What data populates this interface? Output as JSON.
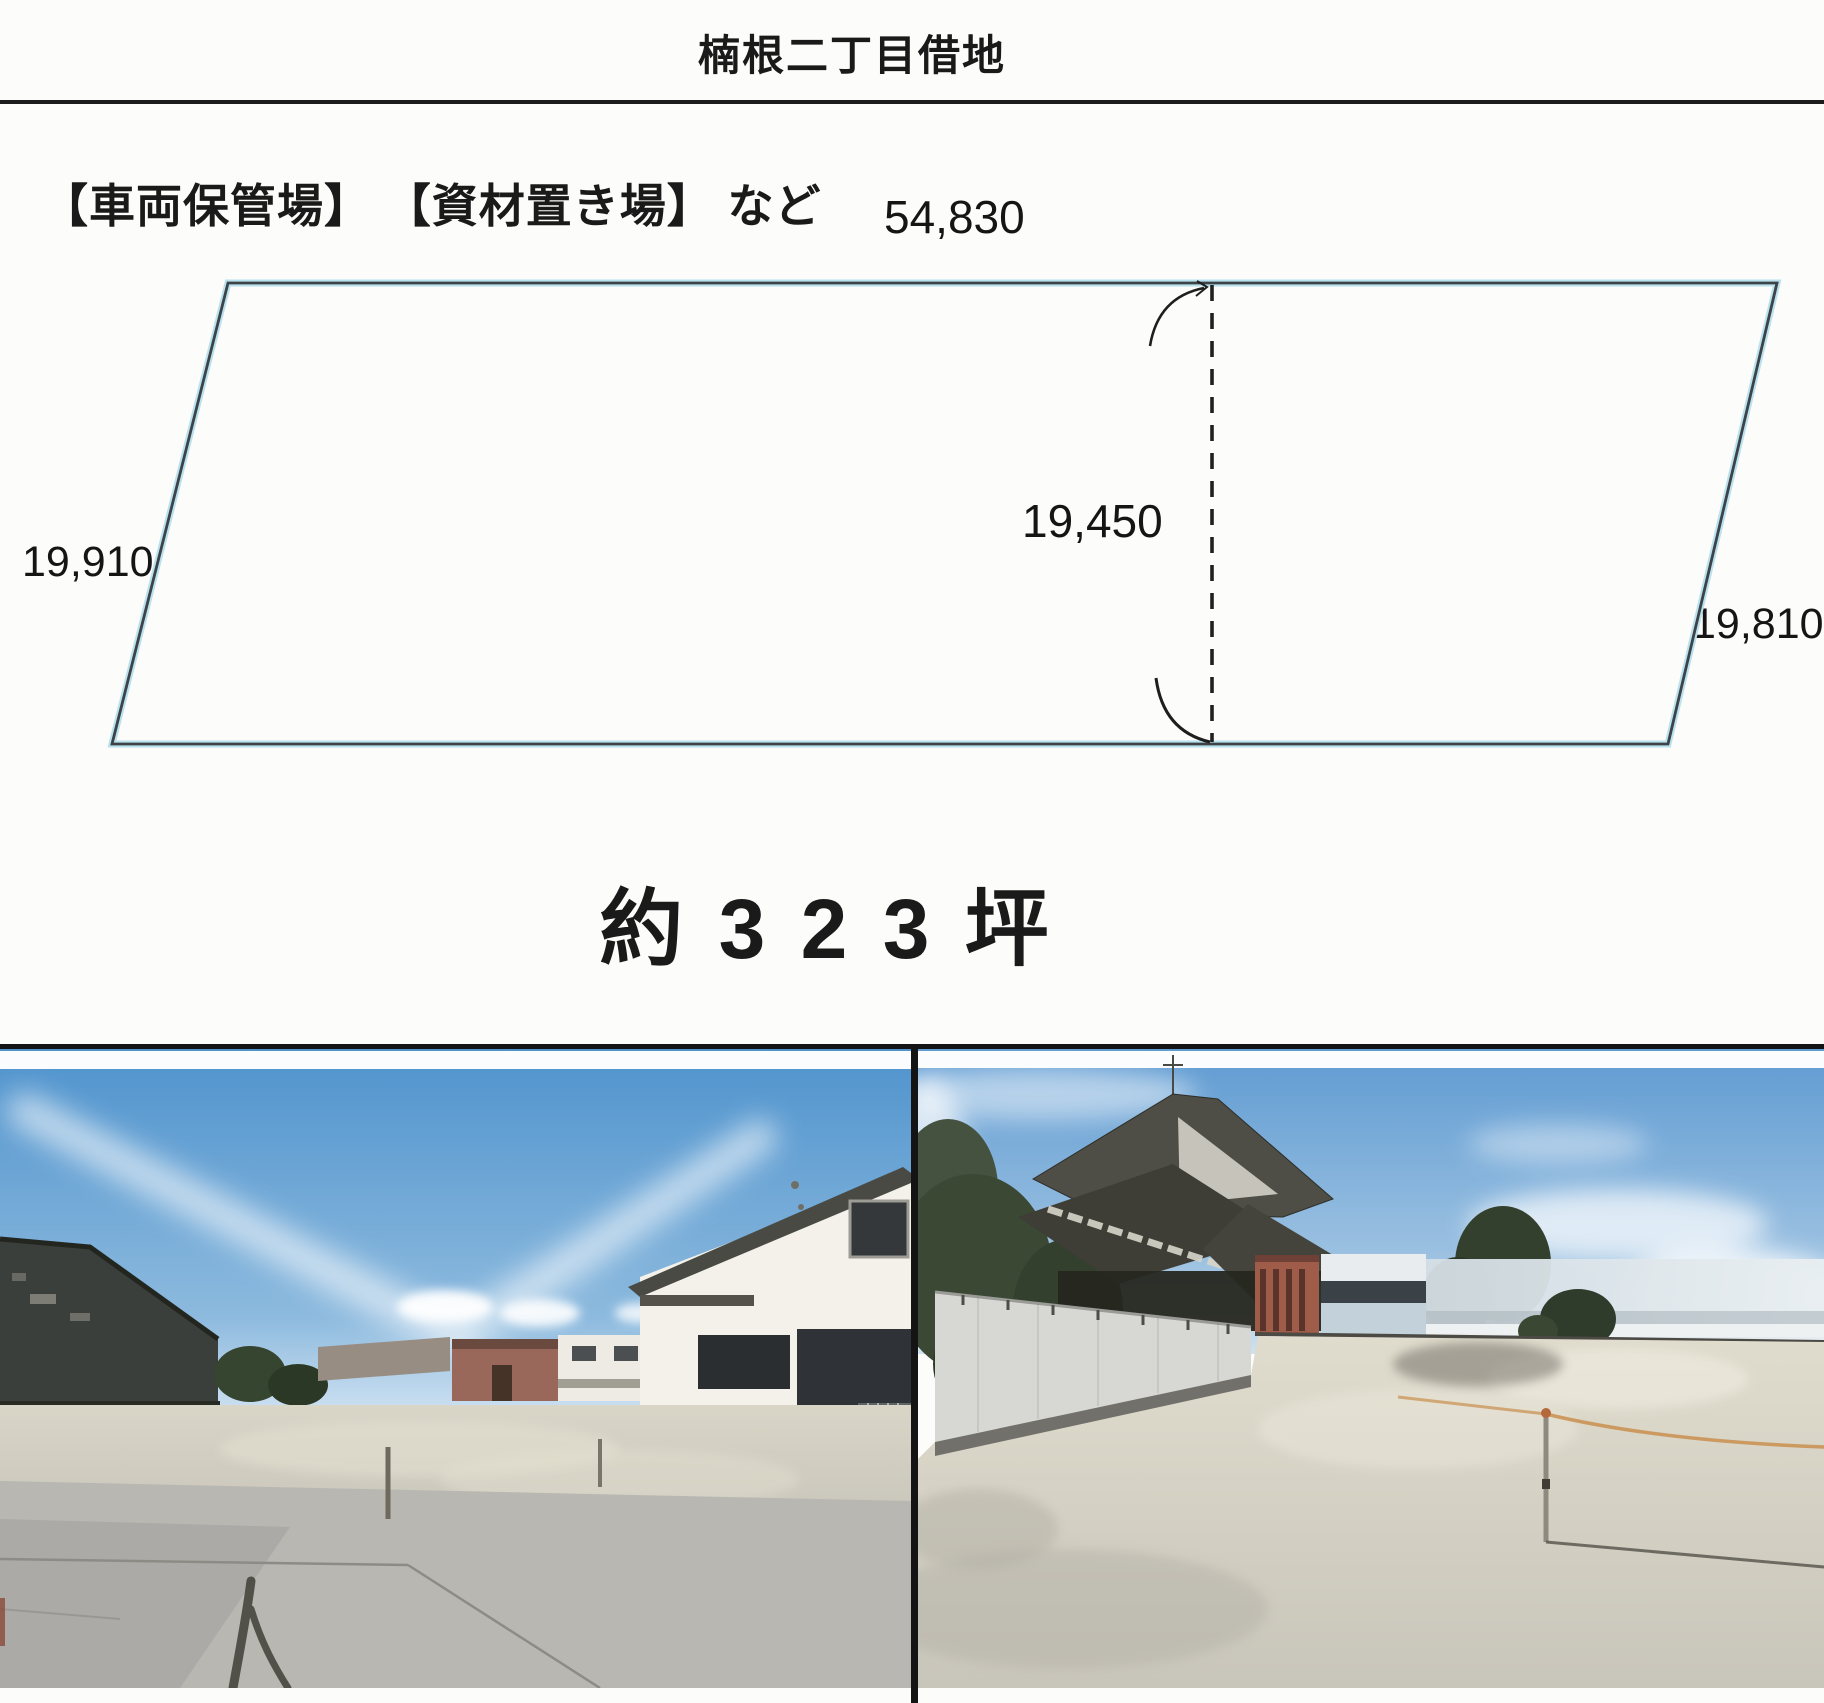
{
  "header": {
    "title": "楠根二丁目借地"
  },
  "usage": {
    "label": "【車両保管場】 【資材置き場】 など"
  },
  "diagram": {
    "top_dimension": "54,830",
    "left_dimension": "19,910",
    "center_dimension": "19,450",
    "right_dimension": "19,810"
  },
  "area": {
    "label": "約 3 2 3 坪"
  },
  "colors": {
    "plot_outline": "#3d4347",
    "scan_halo": "#b9e2ee",
    "rule_line": "#1c1c1c",
    "photo_border": "#141414",
    "sky_blue": "#4f93cd"
  }
}
